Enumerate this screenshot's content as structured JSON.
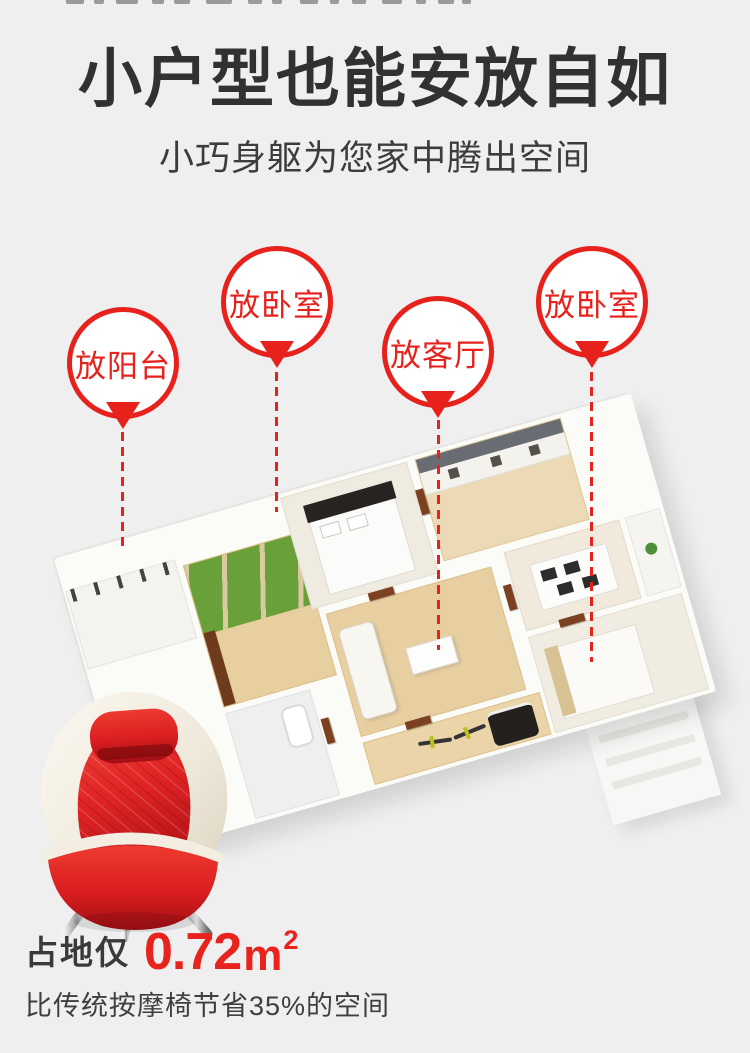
{
  "page": {
    "background_color": "#efeff0",
    "accent_red": "#e7211c"
  },
  "header": {
    "title": "小户型也能安放自如",
    "subtitle": "小巧身躯为您家中腾出空间"
  },
  "markers": {
    "style": "red-balloon-pin-with-dashed-leader",
    "items": [
      {
        "label": "放阳台"
      },
      {
        "label": "放卧室"
      },
      {
        "label": "放客厅"
      },
      {
        "label": "放卧室"
      }
    ]
  },
  "floorplan": {
    "description": "3D isometric rendering of a small apartment: balcony, garden balcony, bathroom, two bedrooms, living room with sofa, kitchen, dining area, entry hall"
  },
  "product": {
    "description": "red egg-shaped mini massage chair with chrome legs"
  },
  "footprint": {
    "prefix": "占地仅",
    "value": "0.72",
    "unit": "m",
    "unit_exponent": "2",
    "value_color": "#e8231e",
    "note": "比传统按摩椅节省35%的空间"
  }
}
